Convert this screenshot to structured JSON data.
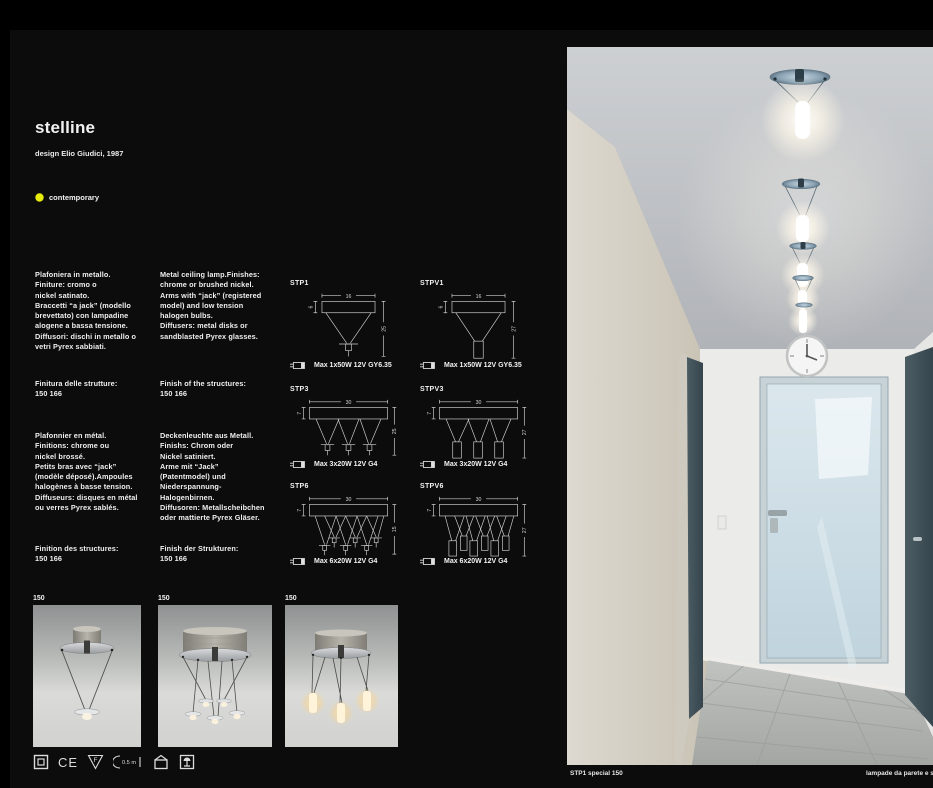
{
  "header": {
    "title": "stelline",
    "designer": "design Elio Giudici, 1987",
    "category": "contemporary",
    "category_dot_color": "#e6eb0b"
  },
  "descriptions": {
    "italian": "Plafoniera in metallo.\nFiniture: cromo o\nnickel satinato.\nBraccetti “a jack” (modello\nbrevettato) con lampadine\nalogene a bassa tensione.\nDiffusori: dischi in metallo o\nvetri Pyrex sabbiati.",
    "italian_finish": "Finitura delle strutture:\n150 166",
    "english": "Metal ceiling lamp.Finishes:\nchrome or brushed nickel.\nArms with “jack” (registered\nmodel) and low tension\nhalogen bulbs.\nDiffusers: metal disks or\nsandblasted Pyrex glasses.",
    "english_finish": "Finish of the structures:\n150 166",
    "french": "Plafonnier en métal.\nFinitions: chrome ou\nnickel brossé.\nPetits bras avec “jack”\n(modèle déposé).Ampoules\nhalogènes à basse tension.\nDiffuseurs: disques en métal\nou verres Pyrex sablés.",
    "french_finish": "Finition des structures:\n150 166",
    "german": "Deckenleuchte aus Metall.\nFinishs: Chrom oder\nNickel satiniert.\nArme mit “Jack”\n(Patentmodel) und\nNiederspannung-\nHalogenbirnen.\nDiffusoren: Metallscheibchen\noder mattierte Pyrex Gläser.",
    "german_finish": "Finish der Strukturen:\n150 166"
  },
  "diagrams": [
    {
      "code": "STP1",
      "width_dim": "16",
      "plate_dim": "6",
      "height_dim": "25",
      "lamp_spec": "Max 1x50W 12V GY6.35"
    },
    {
      "code": "STPV1",
      "width_dim": "16",
      "plate_dim": "6",
      "height_dim": "27",
      "lamp_spec": "Max 1x50W 12V GY6.35"
    },
    {
      "code": "STP3",
      "width_dim": "30",
      "plate_dim": "7",
      "height_dim": "25",
      "lamp_spec": "Max 3x20W 12V G4"
    },
    {
      "code": "STPV3",
      "width_dim": "30",
      "plate_dim": "7",
      "height_dim": "27",
      "lamp_spec": "Max 3x20W 12V G4"
    },
    {
      "code": "STP6",
      "width_dim": "30",
      "plate_dim": "7",
      "height_dim": "15",
      "lamp_spec": "Max 6x20W 12V G4"
    },
    {
      "code": "STPV6",
      "width_dim": "30",
      "plate_dim": "7",
      "height_dim": "27",
      "lamp_spec": "Max 6x20W 12V G4"
    }
  ],
  "product_photos": [
    {
      "label": "150"
    },
    {
      "label": "150"
    },
    {
      "label": "150"
    }
  ],
  "cert_icons": {
    "ce_label": "CE",
    "f_label": "F",
    "distance_label": "0.5 m"
  },
  "photo": {
    "caption_left": "STP1 special 150",
    "caption_right": "lampade da parete e soffitto"
  }
}
